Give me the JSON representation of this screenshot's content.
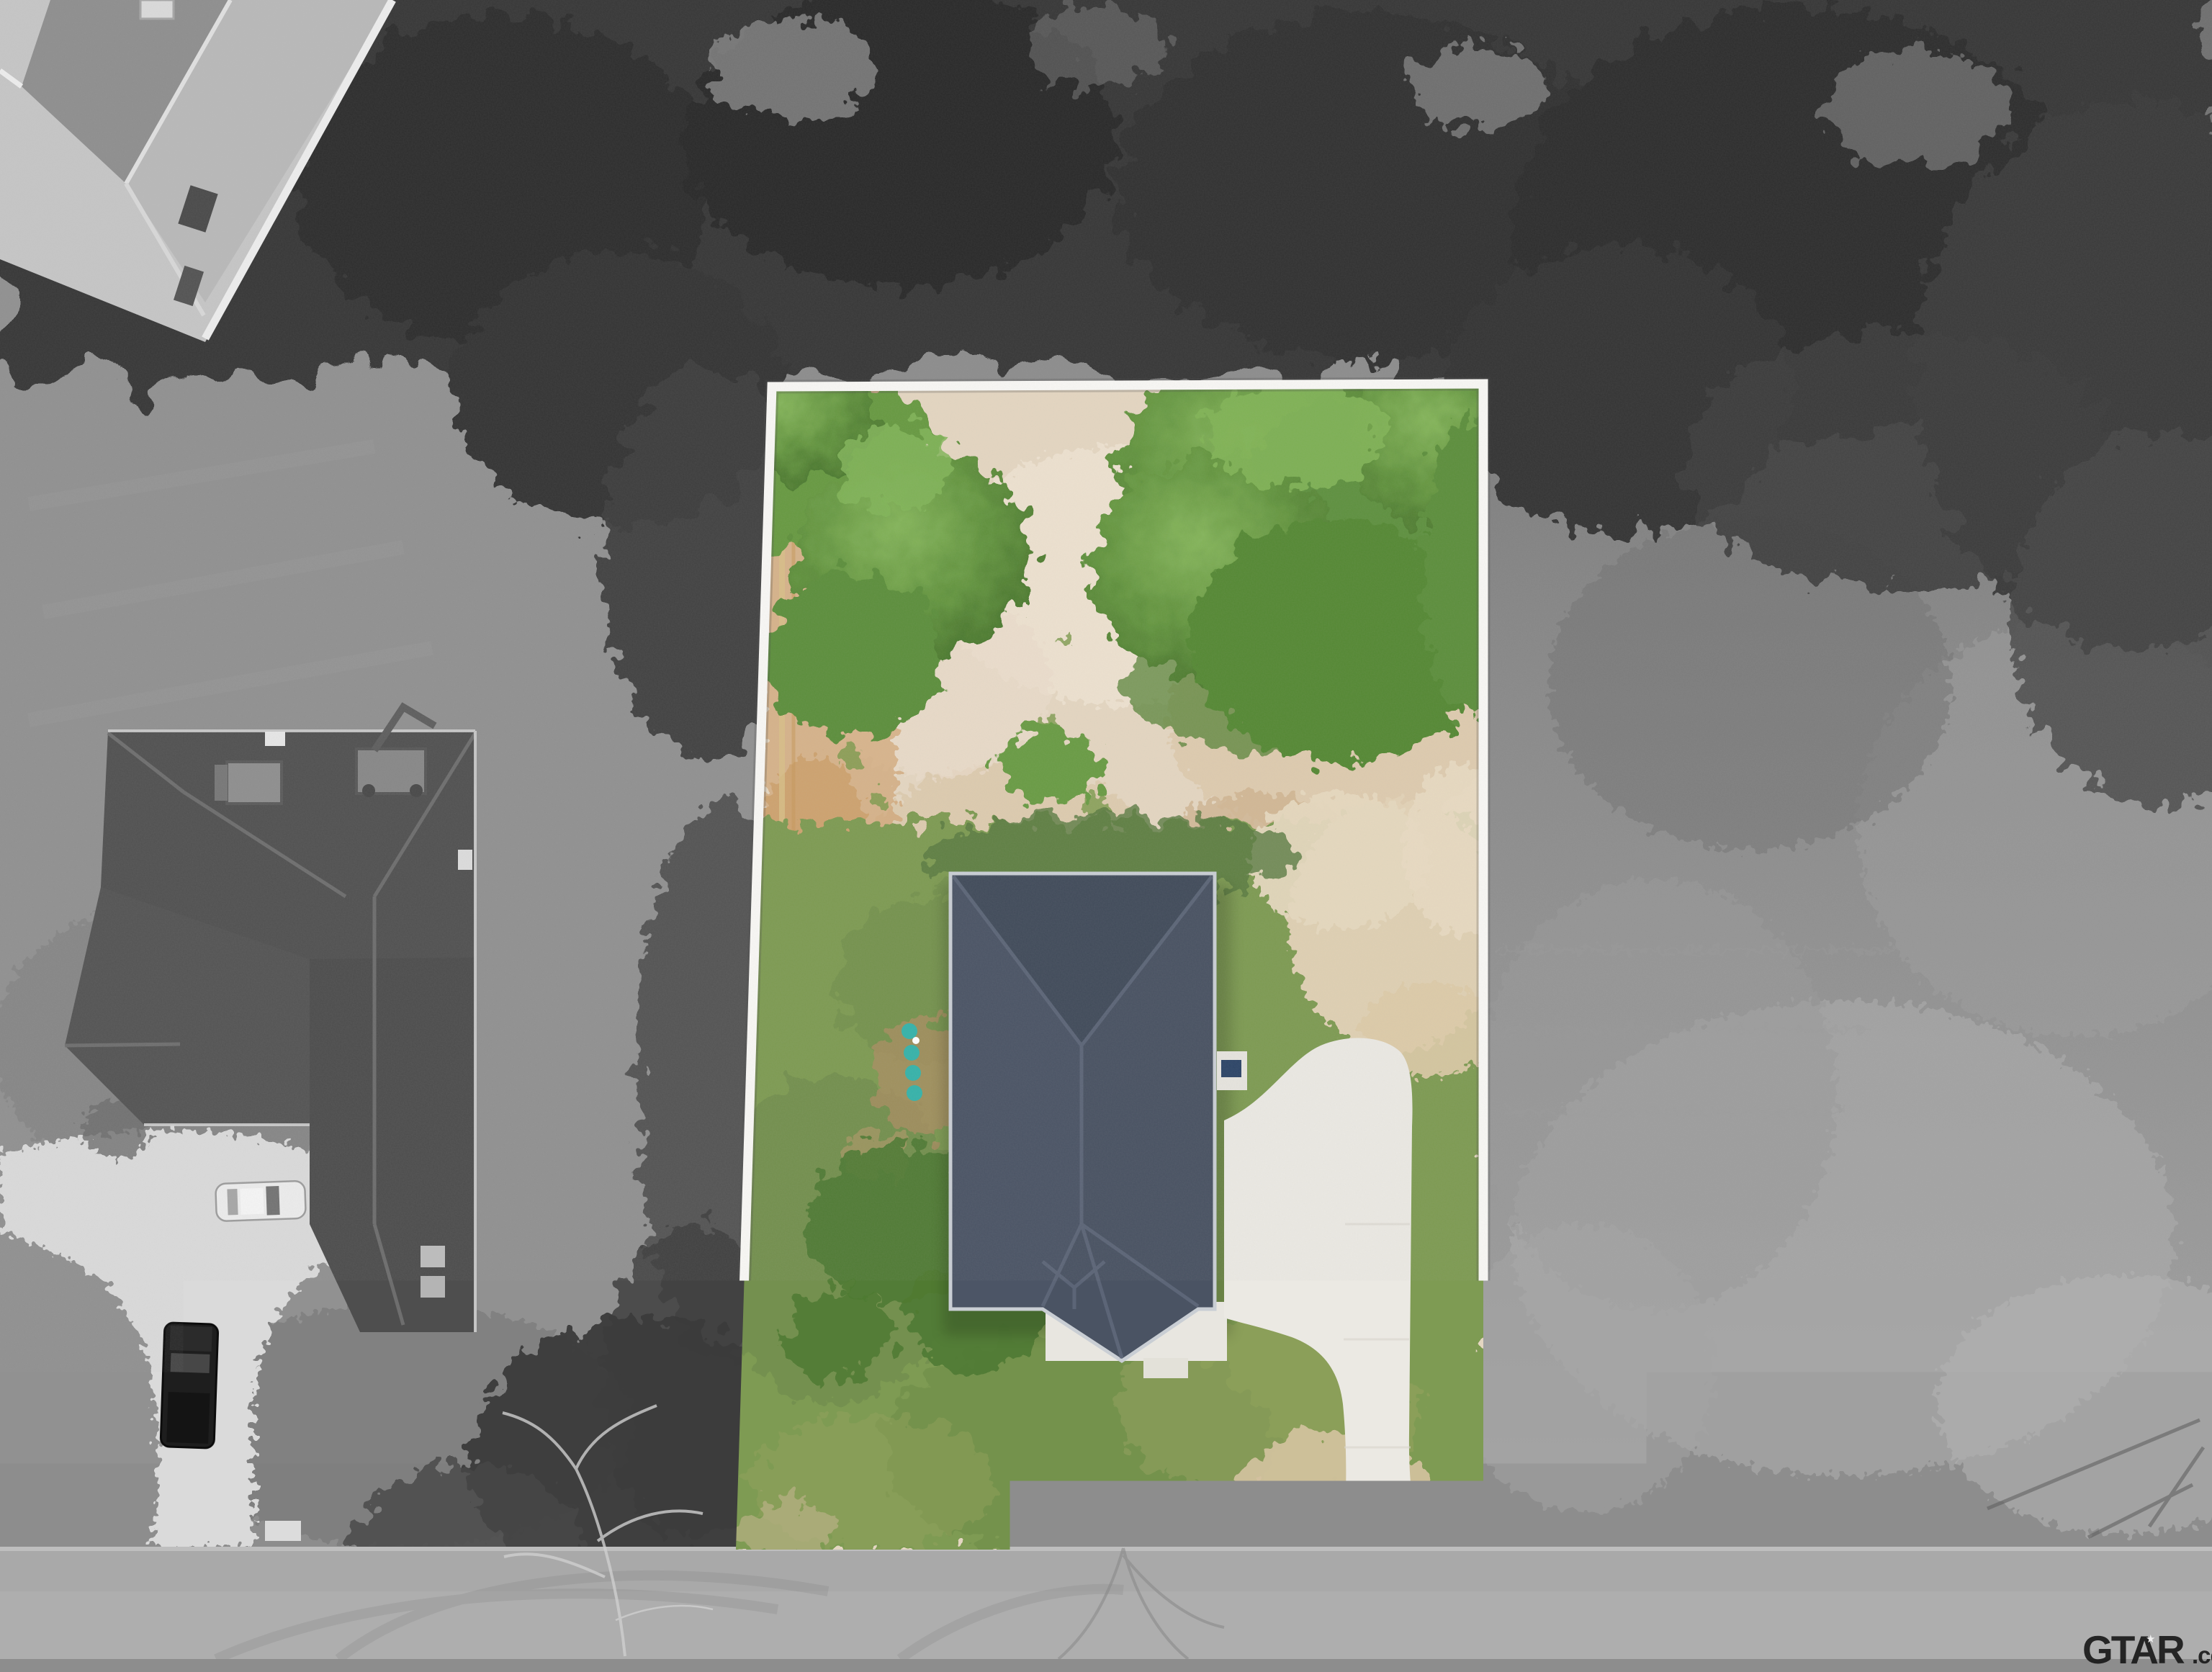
{
  "overlays": {
    "disclaimer_text": "Lot Lines Do Not Represent Official Survey",
    "watermark": {
      "brand": "GTAR",
      "tld": ".com",
      "star_glyph": "★"
    }
  },
  "palette": {
    "background_gray": "#8d8d8d",
    "tree_dark_gray": "#383838",
    "road_gray": "#a9a9a9",
    "lot_line_white": "#f8f7f4",
    "dirt_tan": "#e4d6c1",
    "lawn_green": "#7e9b52",
    "canopy_green": "#679a43",
    "roof_slate": "#4a5363",
    "driveway_concrete": "#ebe9e3",
    "utility_marker_teal": "#37b3aa"
  }
}
